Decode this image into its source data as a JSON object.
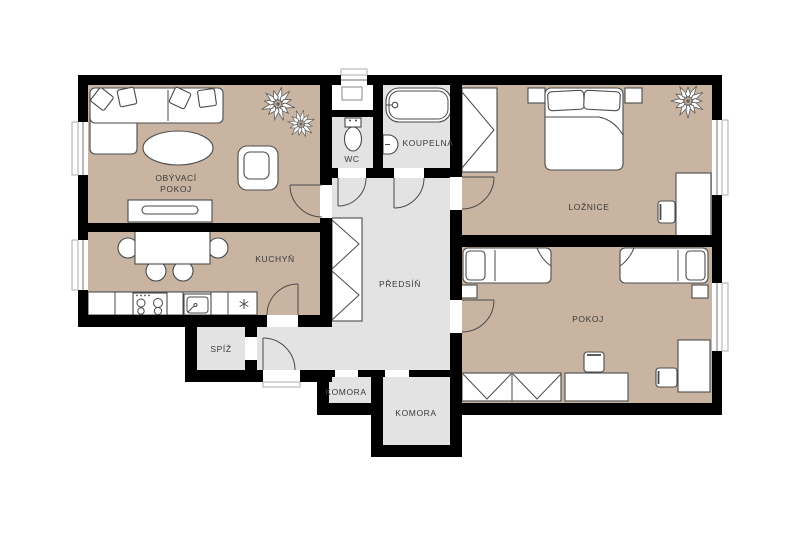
{
  "floor_plan": {
    "type": "apartment-floor-plan",
    "colors": {
      "wall": "#000000",
      "room_floor_tan": "#c9b4a1",
      "room_floor_gray": "#e3e3e3",
      "furniture_outline": "#4a4a4a",
      "label_text": "#3a3a3a",
      "background": "#ffffff"
    },
    "rooms": {
      "living": {
        "line1": "OBÝVACÍ",
        "line2": "POKOJ"
      },
      "kitchen": {
        "label": "KUCHYŇ"
      },
      "wc": {
        "label": "WC"
      },
      "bathroom": {
        "label": "KOUPELNA"
      },
      "bedroom": {
        "label": "LOŽNICE"
      },
      "hall": {
        "label": "PŘEDSÍŇ"
      },
      "pantry": {
        "label": "SPÍŽ"
      },
      "closet_small": {
        "label": "KOMORA"
      },
      "closet_large": {
        "label": "KOMORA"
      },
      "kids_room": {
        "label": "POKOJ"
      }
    }
  }
}
